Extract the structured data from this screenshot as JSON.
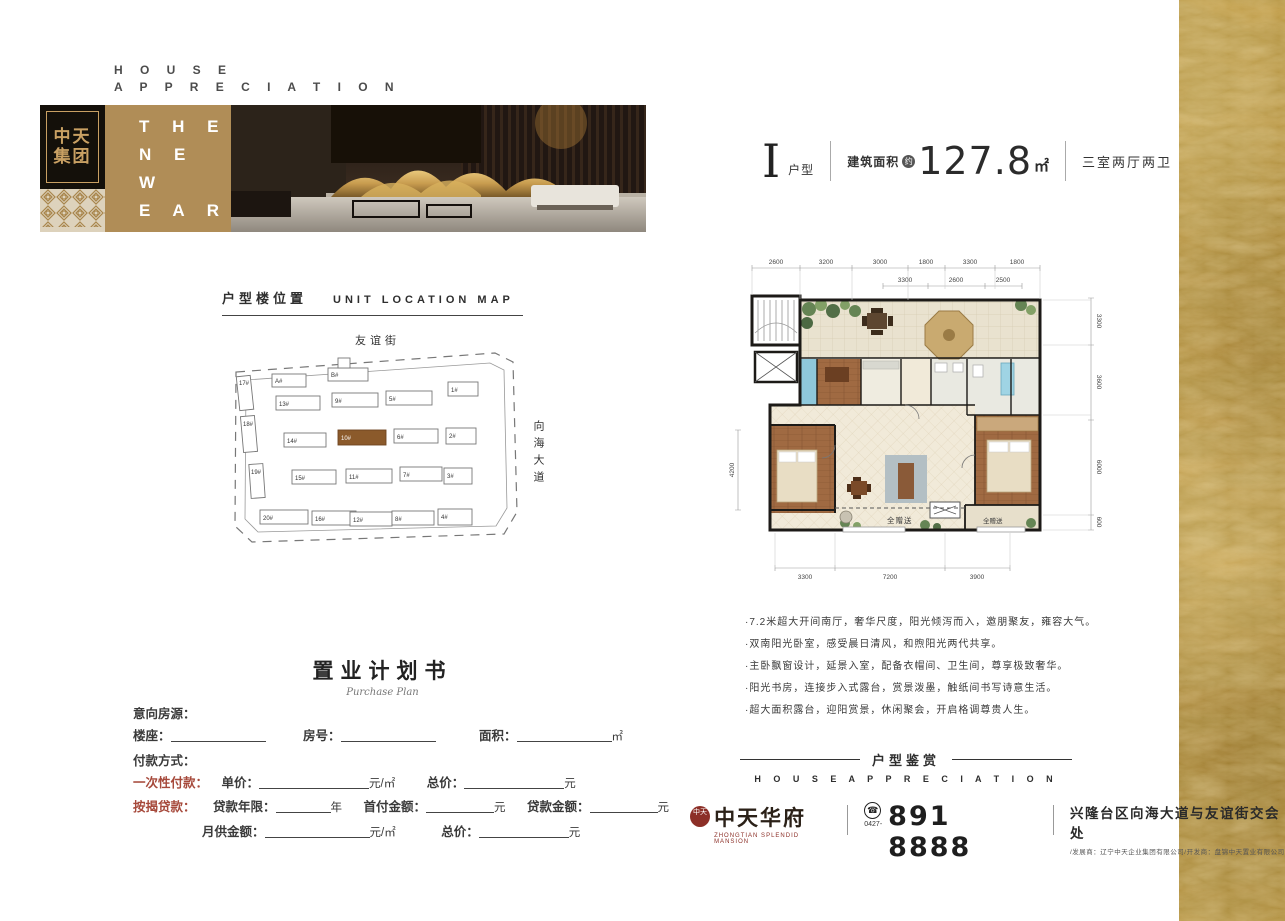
{
  "header": {
    "en_line1": "H O U S E",
    "en_line2": "A P P R E C I A T I O N"
  },
  "brand": {
    "logo_group": "中天集团",
    "tagline_line1": "T H E",
    "tagline_line2": "N E W",
    "tagline_line3": "E A R"
  },
  "unit": {
    "type_letter": "I",
    "type_label": "户型",
    "area_label": "建筑面积",
    "area_approx": "约",
    "area_value": "127.8",
    "area_unit": "㎡",
    "rooms": "三室两厅两卫"
  },
  "location_map": {
    "title_cn": "户型楼位置",
    "title_en": "UNIT LOCATION MAP",
    "street_top": "友谊街",
    "street_right": "向海大道",
    "buildings": [
      "17#",
      "A#",
      "B#",
      "13#",
      "9#",
      "5#",
      "1#",
      "18#",
      "14#",
      "10#",
      "6#",
      "2#",
      "19#",
      "15#",
      "11#",
      "7#",
      "3#",
      "20#",
      "16#",
      "12#",
      "8#",
      "4#"
    ]
  },
  "floorplan": {
    "top1": [
      "2600",
      "3200",
      "3000",
      "1800",
      "3300",
      "1800"
    ],
    "top2": [
      "3300",
      "2600",
      "2500"
    ],
    "right": [
      "3300",
      "3600",
      "6000",
      "600"
    ],
    "left": [
      "4200"
    ],
    "bottom": [
      "3300",
      "7200",
      "3900"
    ],
    "gift": "全赠送"
  },
  "features": {
    "bullets": [
      "·7.2米超大开间南厅，奢华尺度，阳光倾泻而入，邀朋聚友，雍容大气。",
      "·双南阳光卧室，感受晨日清风，和煦阳光两代共享。",
      "·主卧飘窗设计，延景入室，配备衣帽间、卫生间，尊享极致奢华。",
      "·阳光书房，连接步入式露台，赏景泼墨，触纸间书写诗意生活。",
      "·超大面积露台，迎阳赏景，休闲聚会，开启格调尊贵人生。"
    ]
  },
  "appreciation": {
    "title_cn": "户型鉴赏",
    "title_en": "H O U S E   A P P R E C I A T I O N"
  },
  "pform": {
    "title_cn": "置业计划书",
    "title_en": "Purchase Plan",
    "intent_label": "意向房源：",
    "building_label": "楼座：",
    "room_label": "房号：",
    "area_label": "面积：",
    "area_unit": "㎡",
    "payment_label": "付款方式：",
    "onetime_label": "一次性付款：",
    "unit_price_label": "单价：",
    "per_unit": "元/㎡",
    "total_label": "总价：",
    "yuan": "元",
    "mortgage_label": "按揭贷款：",
    "loan_years_label": "贷款年限：",
    "year_unit": "年",
    "downpay_label": "首付金额：",
    "loan_amount_label": "贷款金额：",
    "monthly_label": "月供金额："
  },
  "footer": {
    "seal": "中天",
    "brand_name": "中天华府",
    "brand_sub": "ZHONGTIAN SPLENDID MANSION",
    "phone_icon": "☎",
    "phone_area": "0427-",
    "phone": "891 8888",
    "address": "兴隆台区向海大道与友谊街交会处",
    "developers": "/发展商：辽宁中天企业集团有限公司/开发商：盘锦中天置业有限公司"
  },
  "colors": {
    "accent_gold": "#b08d57",
    "seal_red": "#8c2f27",
    "form_red": "#a6493b",
    "highlight_building": "#8b5a2b"
  }
}
